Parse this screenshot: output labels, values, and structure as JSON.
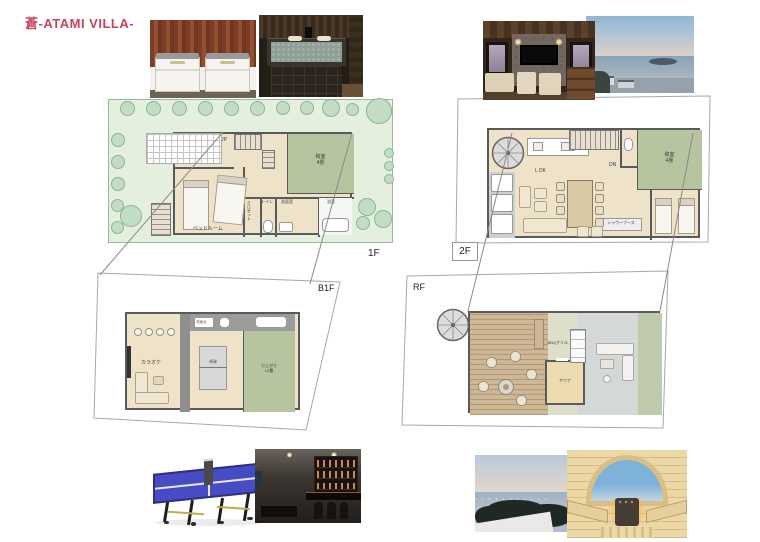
{
  "title": "蒼-ATAMI VILLA-",
  "colors": {
    "title_red": "#c8445c",
    "tatami_green": "#b7c4a0",
    "garden_green": "#e4efdd",
    "plan_floor_beige": "#eee3c8",
    "wall_gray": "#5a5a5a",
    "table_tennis_blue": "#474cc4"
  },
  "floor_plans": {
    "f1": {
      "label": "1F",
      "rooms": {
        "up": "UP",
        "bedroom": "ベッドルーム",
        "washitsu": "和室",
        "washitsu_size": "4畳",
        "closet": "クロゼット",
        "toilet": "トイレ",
        "washroom": "洗面室",
        "bath": "浴室"
      }
    },
    "f2": {
      "label": "2F",
      "rooms": {
        "ldk": "L DK",
        "dn": "DN",
        "washitsu": "和室",
        "washitsu_size": "4畳",
        "shower": "シャワーブース"
      }
    },
    "b1f": {
      "label": "B1F",
      "rooms": {
        "karaoke": "カラオケ",
        "table_tennis": "卓球",
        "koagari": "小上がり",
        "koagari_size": "12畳",
        "vanity": "洗面台"
      }
    },
    "rf": {
      "label": "RF",
      "rooms": {
        "sauna": "サウナ",
        "bbq": "BBQグリル"
      }
    }
  }
}
